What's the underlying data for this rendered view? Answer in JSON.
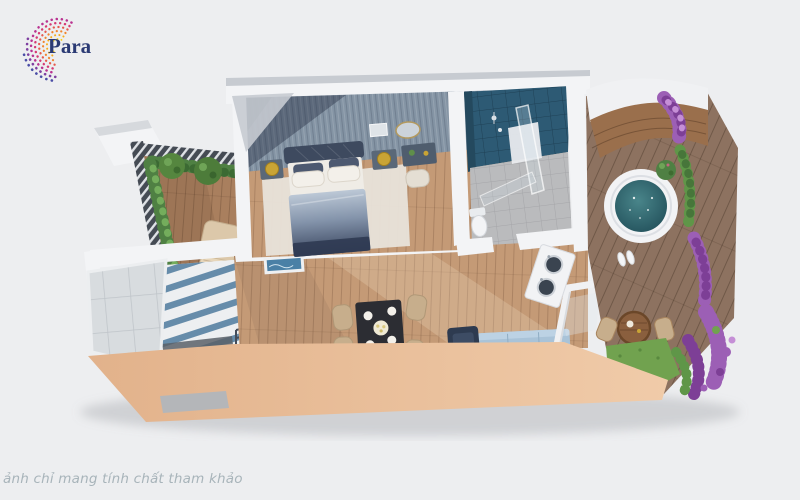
{
  "logo": {
    "visible_text": "Para",
    "text_color": "#2b3a74",
    "swirl_colors": [
      "#f7d016",
      "#f6ab1a",
      "#f1852e",
      "#e65a4e",
      "#d63a74",
      "#b93391",
      "#7e3fa0",
      "#4a4da6"
    ]
  },
  "disclaimer": {
    "text": "ảnh chỉ mang tính chất tham khảo"
  },
  "palette": {
    "background": "#edeef0",
    "wall_white": "#f3f4f6",
    "wall_shadow": "#d6d9dd",
    "roof_gray": "#c7cbd1",
    "facade_peach_light": "#f0cba9",
    "facade_peach_dark": "#e2b28b",
    "wood_floor": "#c49a76",
    "wood_deck_left": "#a97f5e",
    "wood_deck_right": "#8d7260",
    "accent_wall": "#8494a4",
    "tile_blue": "#2d5a74",
    "tile_blue_dark": "#1f4156",
    "tile_gray_floor": "#babbbd",
    "glass_gray": "#d8dcdf",
    "rug_beige": "#e8e3da",
    "bed_headboard": "#3e4a5f",
    "duvet_light": "#bcc8d6",
    "duvet_dark": "#39455e",
    "pillow_white": "#f3f0ea",
    "nightstand_blue": "#5a6878",
    "lamp_gold": "#c9a435",
    "sofa_blue": "#a9c3d8",
    "armchair_navy": "#2e3b50",
    "table_dark": "#2c2d33",
    "chair_beige": "#c7ae8c",
    "hedge_green": "#4f8043",
    "grass_green": "#71a24f",
    "flower_purple": "#9c5fb5",
    "flower_purple_dark": "#7d3f96",
    "water_teal_center": "#49858a",
    "water_teal_edge": "#1f4c57",
    "stair_blue": "#5b84a4",
    "jacuzzi_white": "#f2f3f5",
    "canopy_wood": "#9a6f4c",
    "disclaimer_gray": "#a8b4ba",
    "logo_navy": "#2b3a74"
  }
}
